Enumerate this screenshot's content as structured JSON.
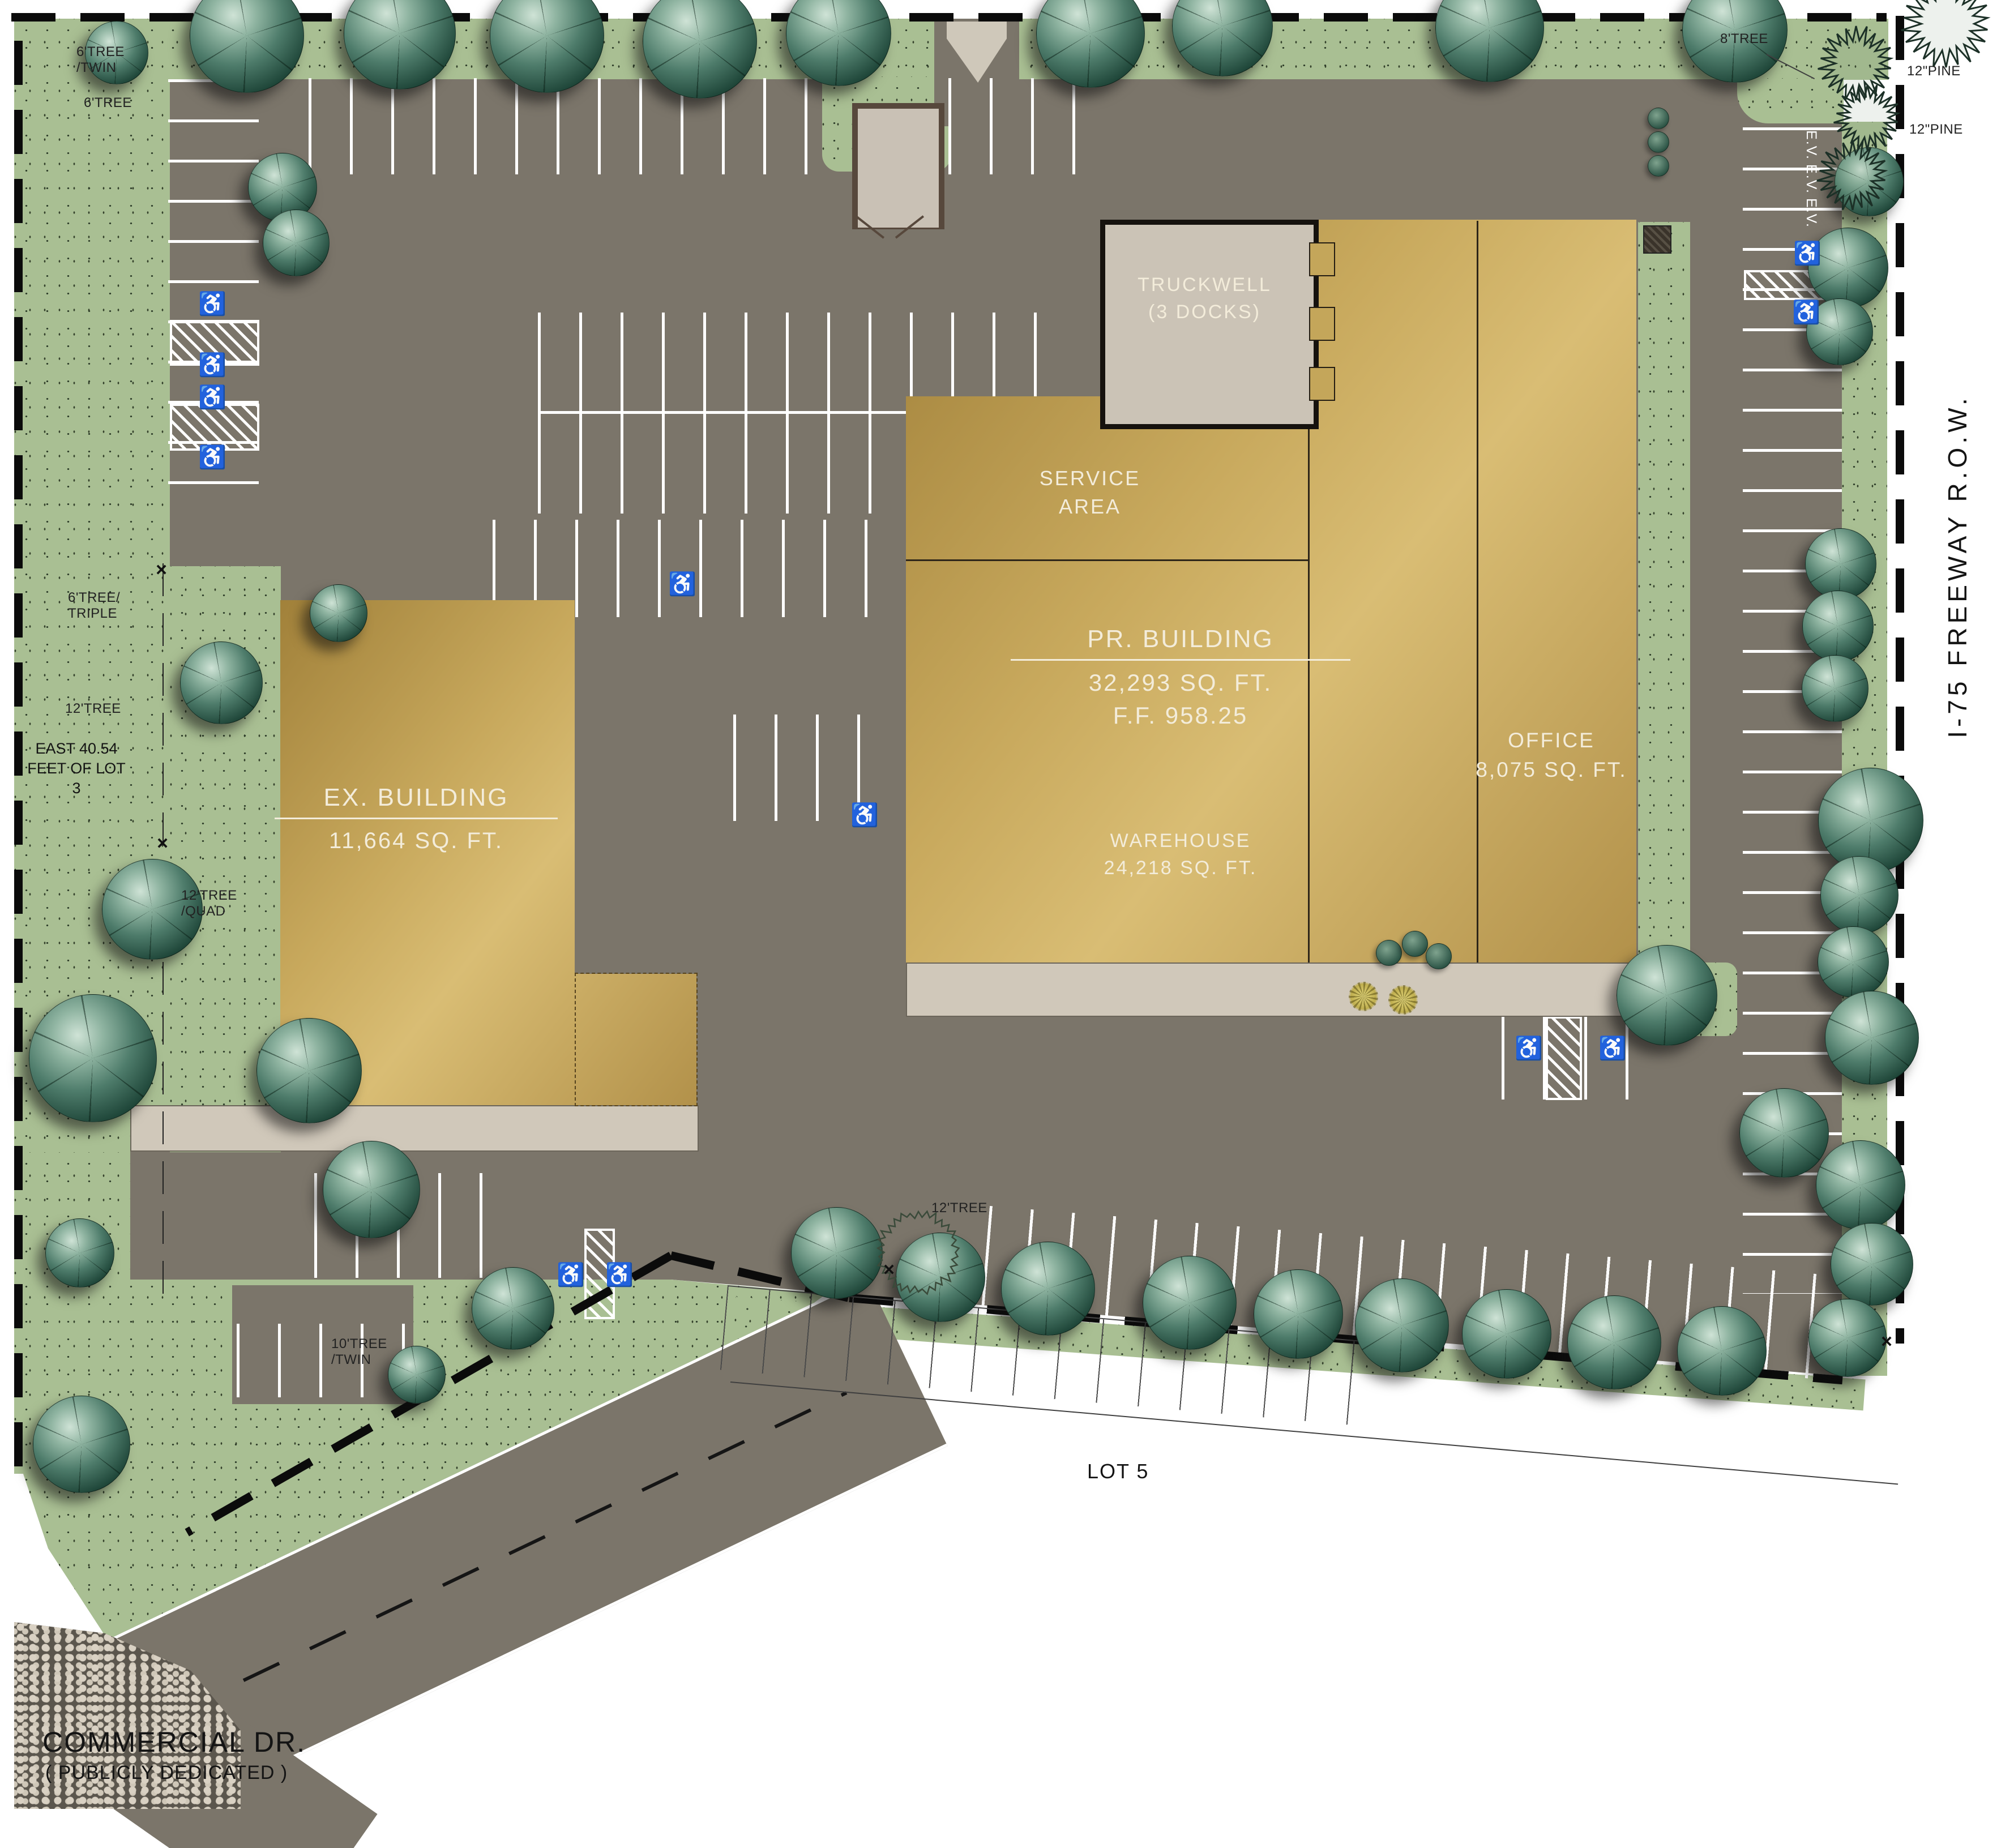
{
  "plan": {
    "buildings": {
      "pr": {
        "title": "PR. BUILDING",
        "area": "32,293 SQ. FT.",
        "ff": "F.F. 958.25",
        "warehouse": {
          "title": "WAREHOUSE",
          "area": "24,218 SQ. FT."
        },
        "office": {
          "title": "OFFICE",
          "area": "8,075 SQ. FT."
        },
        "service": {
          "line1": "SERVICE",
          "line2": "AREA"
        },
        "truckwell": {
          "line1": "TRUCKWELL",
          "line2": "(3 DOCKS)"
        }
      },
      "ex": {
        "title": "EX. BUILDING",
        "area": "11,664 SQ. FT."
      }
    },
    "streets": {
      "commercial": "COMMERCIAL DR.",
      "commercial_note": "( PUBLICLY DEDICATED )",
      "freeway": "I-75 FREEWAY R.O.W."
    },
    "lots": {
      "lot5": "LOT 5",
      "east_forty": {
        "line1": "EAST 40.54",
        "line2": "FEET OF LOT",
        "line3": "3"
      }
    },
    "parking": {
      "ev": "E.V."
    },
    "tree_labels": [
      {
        "line1": "6'TREE",
        "line2": "/TWIN"
      },
      {
        "line1": "6'TREE",
        "line2": ""
      },
      {
        "line1": "8'TREE",
        "line2": ""
      },
      {
        "line1": "12\"PINE",
        "line2": ""
      },
      {
        "line1": "12\"PINE",
        "line2": ""
      },
      {
        "line1": "6'TREE/",
        "line2": "TRIPLE"
      },
      {
        "line1": "12'TREE",
        "line2": ""
      },
      {
        "line1": "12'TREE",
        "line2": "/QUAD"
      },
      {
        "line1": "10'TREE",
        "line2": "/TWIN"
      },
      {
        "line1": "12'TREE",
        "line2": ""
      }
    ],
    "symbols": {
      "handicap": "♿",
      "x_mark": "×"
    },
    "colors": {
      "grass": "#a9bf93",
      "asphalt": "#7b756a",
      "building": "#c8a95d",
      "concrete": "#d0c8ba",
      "tree": "#1d4437",
      "stall_line": "#ffffff",
      "boundary": "#0b0b0b"
    }
  }
}
